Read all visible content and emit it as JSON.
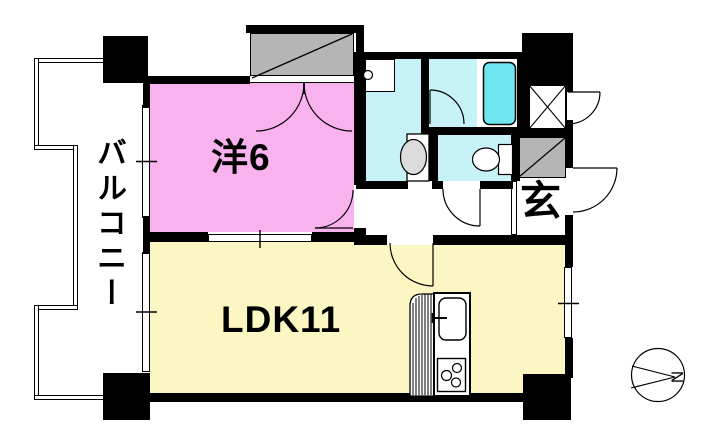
{
  "floor_plan": {
    "rooms": {
      "western": {
        "label": "洋6"
      },
      "ldk": {
        "label": "LDK11"
      },
      "balcony": {
        "label": "バルコニー"
      },
      "entrance": {
        "label": "玄"
      }
    },
    "compass": {
      "north_label": "N"
    },
    "colors": {
      "wall": "#000000",
      "room_western": "#F8B2EE",
      "room_ldk": "#FBF6C2",
      "room_wet": "#C6F2F8",
      "bathtub": "#6FE6F2",
      "cabinet_gray": "#B5B5B5",
      "fixture_gray": "#DCDCDC",
      "line": "#000000"
    }
  }
}
